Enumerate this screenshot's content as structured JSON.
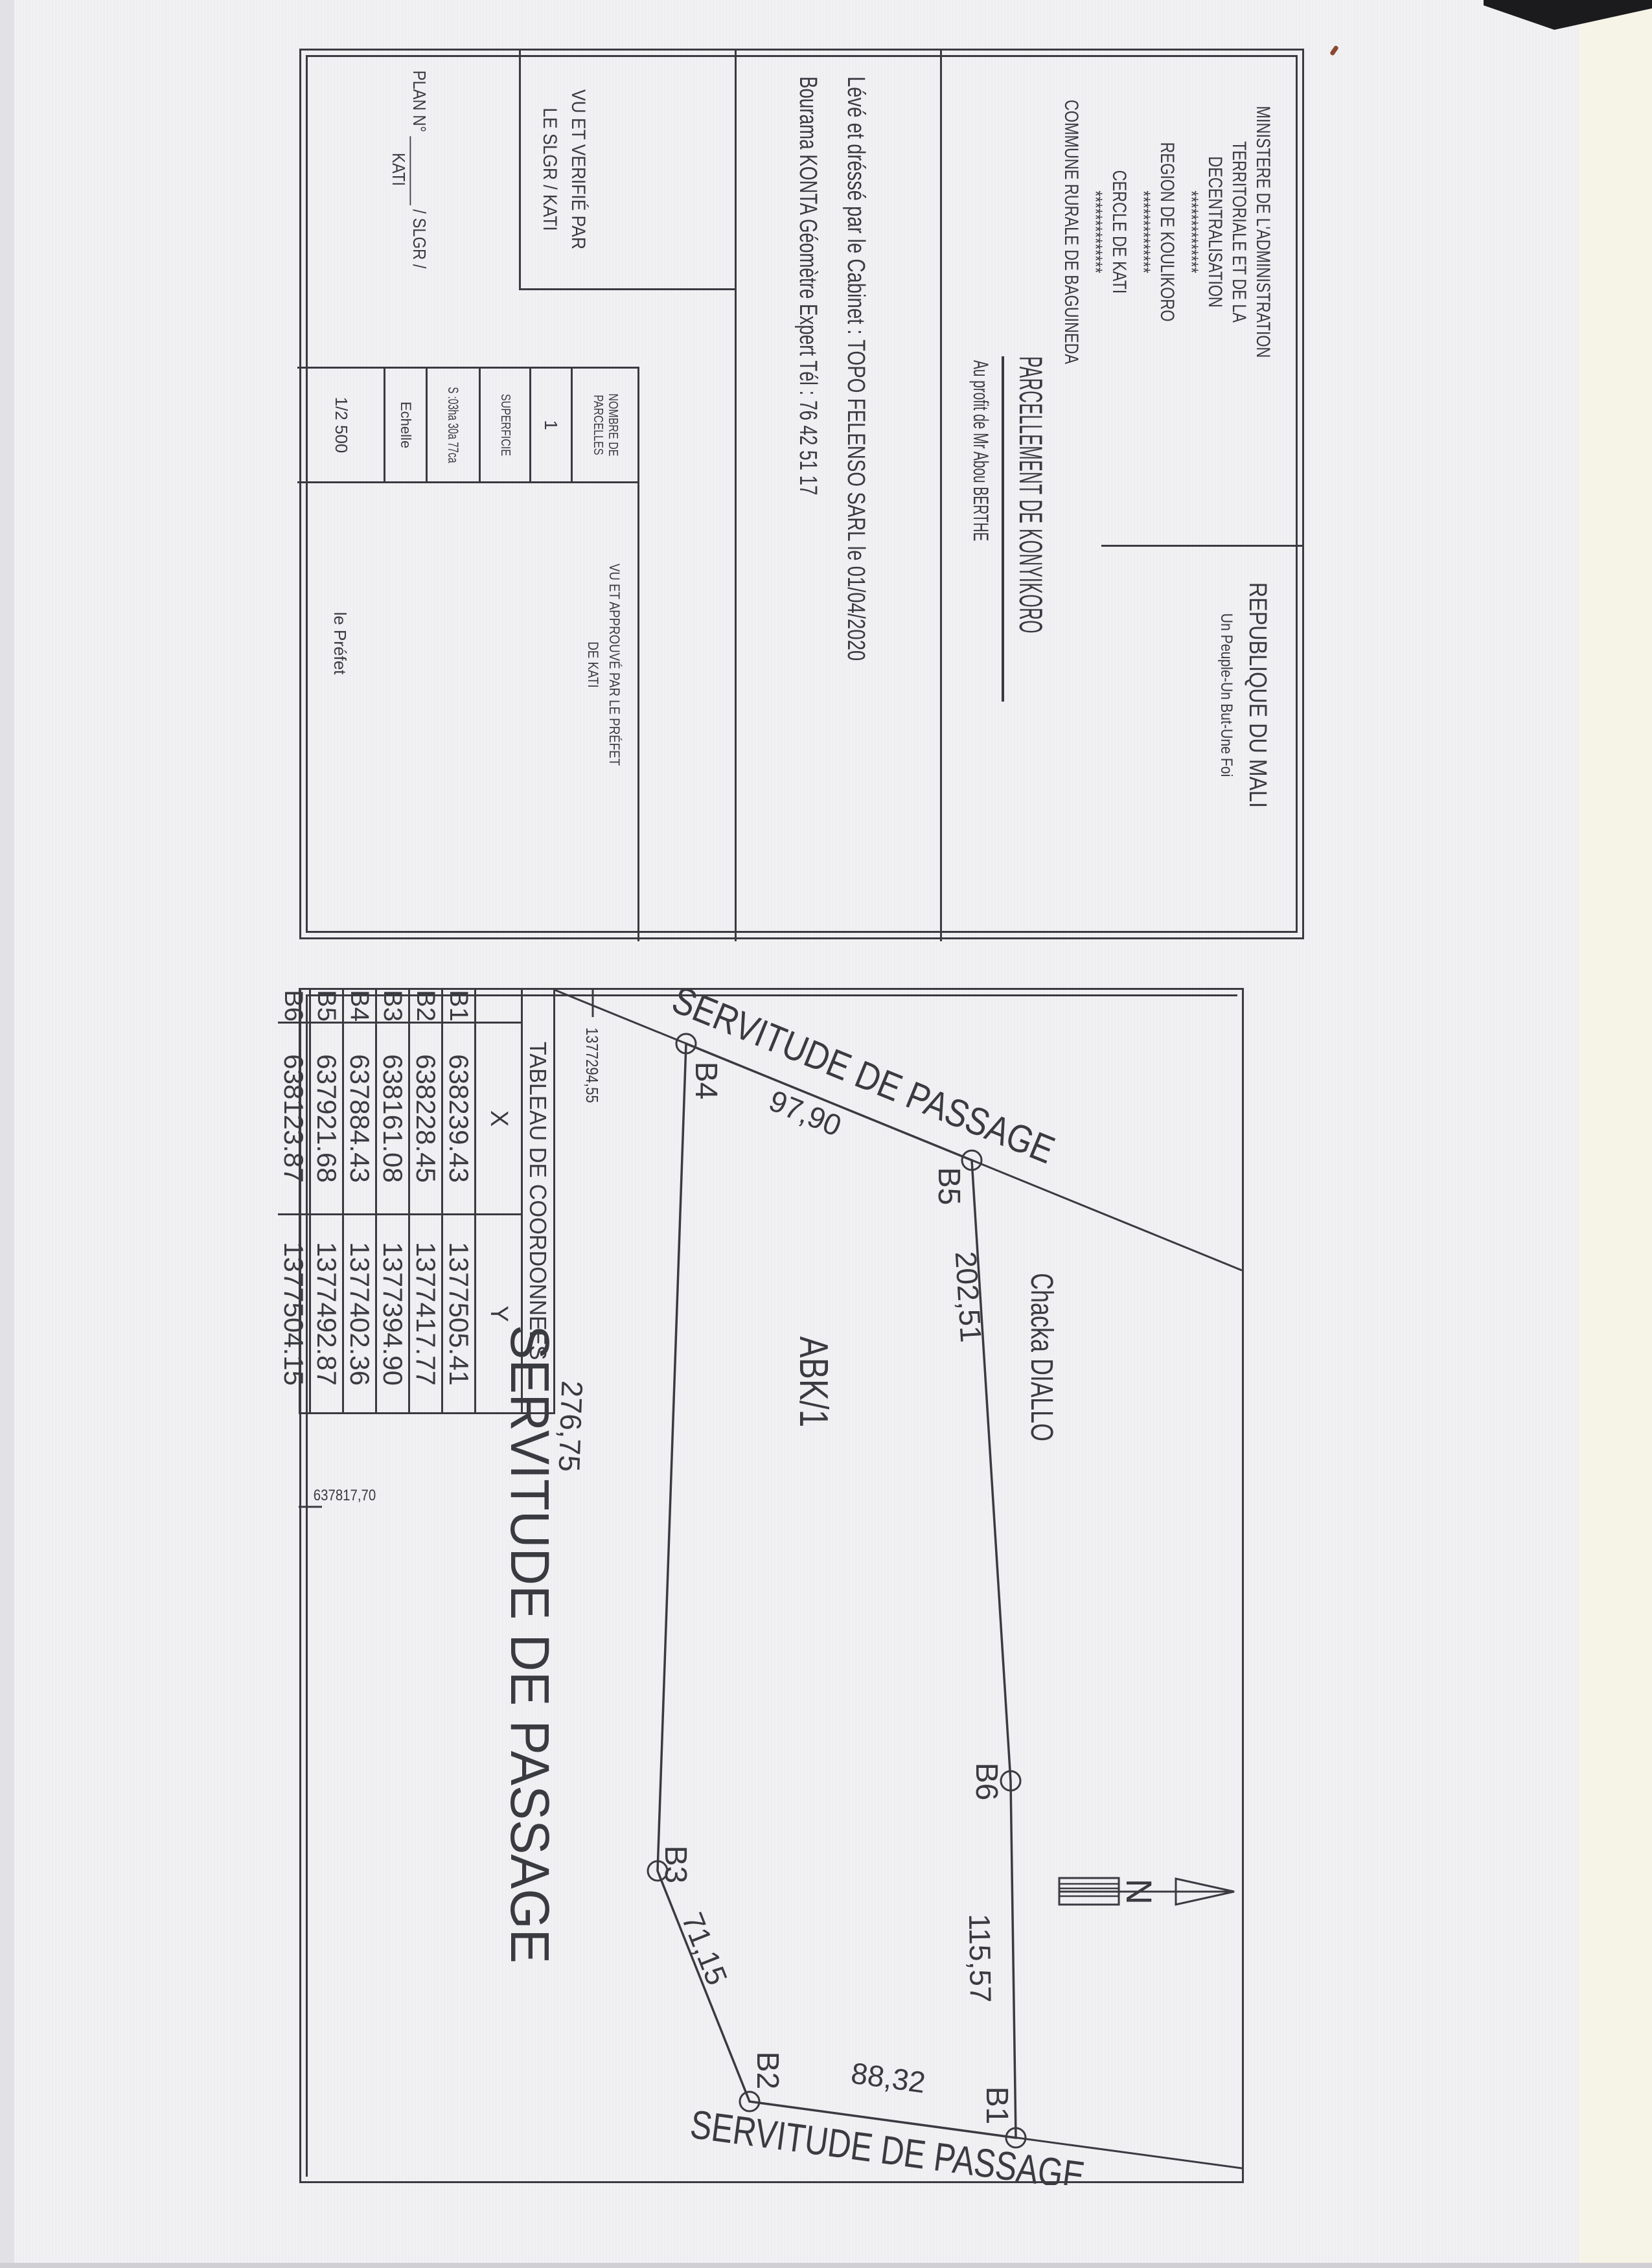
{
  "header": {
    "ministry_lines": [
      "MINISTERE DE L'ADMINISTRATION",
      "TERRITORIALE ET DE LA DECENTRALISATION",
      "**************",
      "REGION DE KOULIKORO",
      "**************",
      "CERCLE DE KATI",
      "**************",
      "COMMUNE RURALE DE BAGUINEDA"
    ],
    "republic": "REPUBLIQUE DU MALI",
    "motto": "Un Peuple-Un But-Une Foi"
  },
  "title": {
    "main": "PARCELLEMENT DE KONYIKORO",
    "beneficiary": "Au profit de Mr Abou BERTHE"
  },
  "surveyor": {
    "line1": "Lévé et dréssé  par le Cabinet : TOPO FELENSO SARL  le 01/04/2020",
    "line2": "Bourama KONTA Géomètre Expert  Tél : 76 42 51 17"
  },
  "approval": {
    "verified_line1": "VU ET VERIFIÉ PAR",
    "verified_line2": "LE SLGR / KATI",
    "plan_no": "PLAN N° ________ / SLGR / KATI",
    "parcels_label": "NOMBRE DE PARCELLES",
    "parcels_value": "1",
    "area_label": "SUPERFICIE",
    "area_value": "S :03ha 30a 77ca",
    "scale_label": "Echelle",
    "scale_value": "1/2 500",
    "approved_line1": "VU ET APPROUVÉ PAR LE PRÉFET",
    "approved_line2": "DE KATI",
    "prefect": "le Préfet"
  },
  "tableau": {
    "title": "TABLEAU DE COORDONNEES",
    "col_x": "X",
    "col_y": "Y",
    "rows": [
      {
        "pt": "B1",
        "x": "638239.43",
        "y": "1377505.41"
      },
      {
        "pt": "B2",
        "x": "638228.45",
        "y": "1377417.77"
      },
      {
        "pt": "B3",
        "x": "638161.08",
        "y": "1377394.90"
      },
      {
        "pt": "B4",
        "x": "637884.43",
        "y": "1377402.36"
      },
      {
        "pt": "B5",
        "x": "637921.68",
        "y": "1377492.87"
      },
      {
        "pt": "B6",
        "x": "638123.87",
        "y": "1377504.15"
      }
    ]
  },
  "plan": {
    "parcel_id": "ABK/1",
    "neighbor": "Chacka DIALLO",
    "servitude_top": "SERVITUDE DE PASSAGE",
    "servitude_left": "SERVITUDE DE PASSAGE",
    "servitude_bottom": "SERVITUDE DE PASSAGE",
    "north": "N",
    "grid_y": "1377294,55",
    "grid_x": "637817,70",
    "vertices": {
      "b1": "B1",
      "b2": "B2",
      "b3": "B3",
      "b4": "B4",
      "b5": "B5",
      "b6": "B6"
    },
    "lengths": {
      "b4b5": "97,90",
      "b5b6": "202,51",
      "b6b1": "115,57",
      "b1b2": "88,32",
      "b2b3": "71,15",
      "b3b4": "276,75"
    }
  }
}
